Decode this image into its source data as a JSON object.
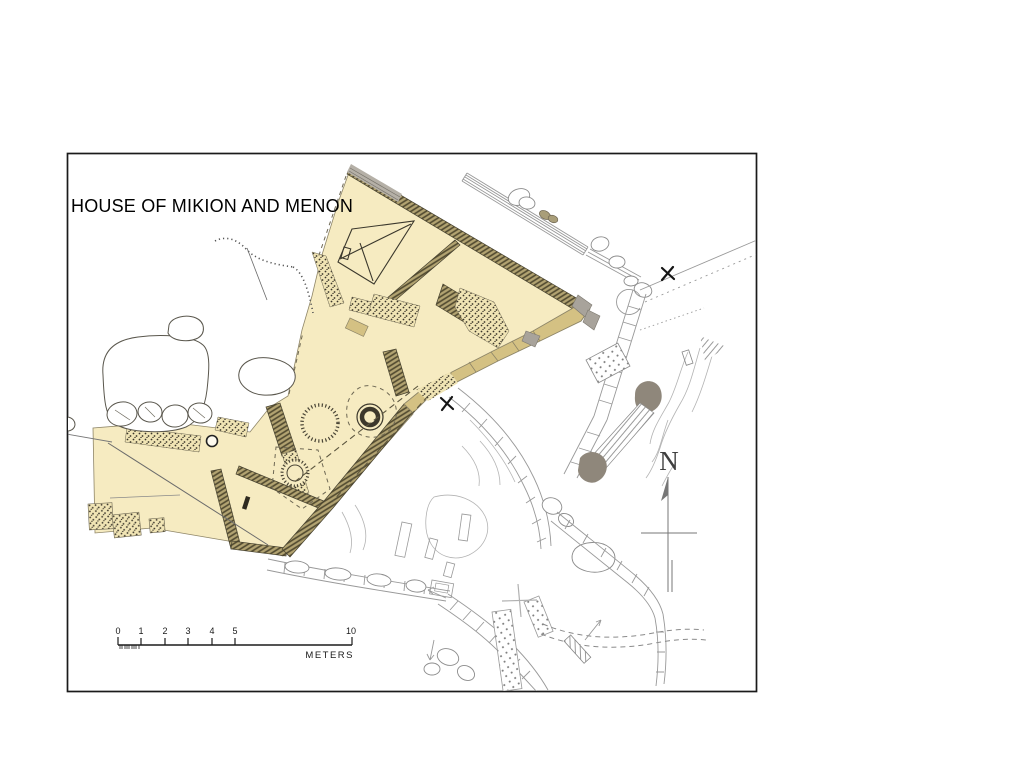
{
  "frame": {
    "title": "HOUSE OF MIKION AND MENON"
  },
  "compass": {
    "label": "N"
  },
  "scale_bar": {
    "tick_labels": [
      "0",
      "1",
      "2",
      "3",
      "4",
      "5",
      "10"
    ],
    "unit_label": "METERS"
  },
  "colors": {
    "house_fill": "#f6ebc1",
    "wall_block_tan": "#d4c183",
    "wall_olive_hatch": "#b2a371",
    "rubble_stipple_bg": "#f0e4b4",
    "gray_feature": "#8f877b",
    "linework_gray": "#999999",
    "frame_border": "#1a1a1a"
  },
  "icons": {
    "north_arrow": "vertical arrow with crossbar",
    "survey_cross": "✕",
    "well": "double ring circle",
    "pit": "dotted circle"
  }
}
